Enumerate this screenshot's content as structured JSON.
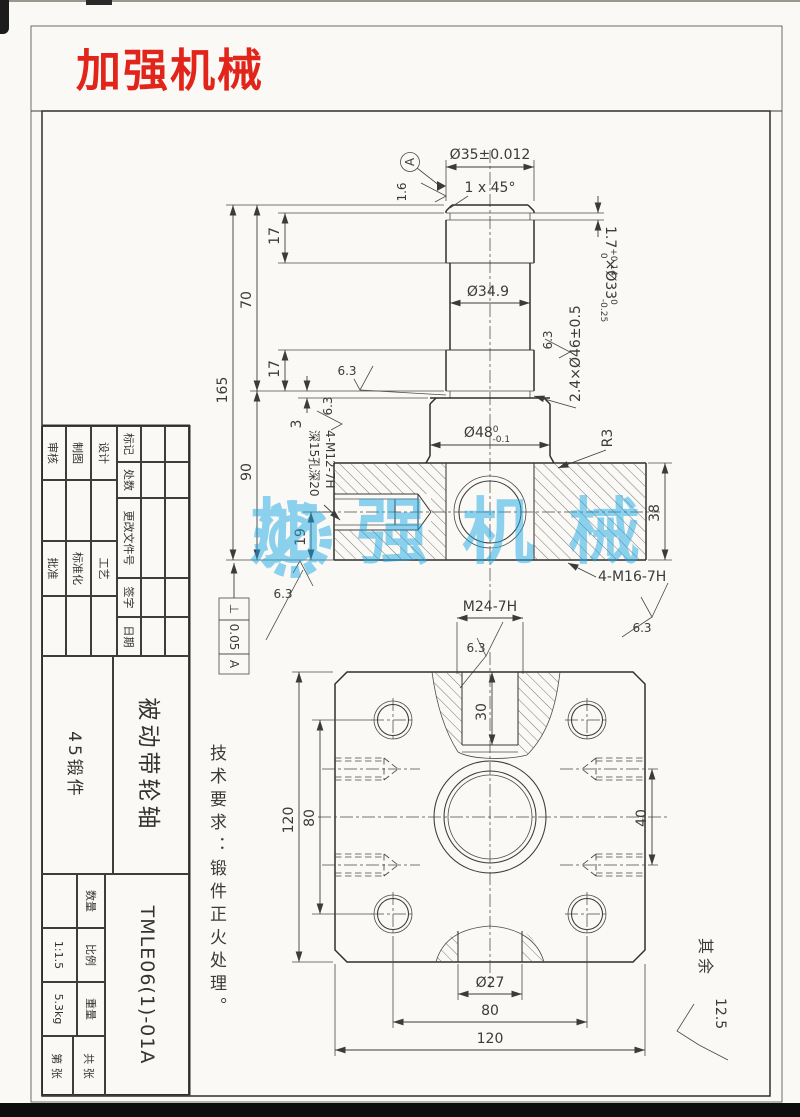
{
  "page": {
    "brand": "加强机械",
    "watermark_text": "加强机械",
    "tech_note": "技术要求：锻件正火处理。",
    "rest_label": "其余",
    "rest_value": "12.5"
  },
  "front": {
    "dia35": "Ø35±0.012",
    "chamfer": "1 x 45°",
    "datum": "A",
    "ra16": "1.6",
    "ra63": "6.3",
    "groove1_main": "1.7",
    "groove1_sup": "+0.14",
    "groove1_sub": "0",
    "groove1_dia": "×Ø33",
    "groove1_dia_sup": "0",
    "groove1_dia_sub": "-0.25",
    "groove2": "2.4×Ø46±0.5",
    "dia349": "Ø34.9",
    "dia48_main": "Ø48",
    "dia48_sup": "0",
    "dia48_sub": "-0.1",
    "r3": "R3",
    "m12_note1": "4-M12-7H",
    "m12_note2": "深15孔深20",
    "m16_note": "4-M16-7H",
    "m24_note": "M24-7H",
    "d165": "165",
    "d70": "70",
    "d17a": "17",
    "d17b": "17",
    "d90": "90",
    "d3": "3",
    "d19": "19",
    "d38": "38",
    "gdt_symbol": "⊥",
    "gdt_value": "0.05",
    "gdt_datum": "A"
  },
  "plan": {
    "d30": "30",
    "d120v": "120",
    "d80v": "80",
    "d40": "40",
    "dia27": "Ø27",
    "d80h": "80",
    "d120h": "120"
  },
  "title_block": {
    "change_headers": [
      "标记",
      "处数",
      "更改文件号",
      "签字",
      "日期"
    ],
    "sign_left": [
      "设计",
      "制图",
      "审核"
    ],
    "sign_right": [
      "工艺",
      "标准化",
      "批准"
    ],
    "part_name": "被动带轮轴",
    "material": "45锻件",
    "drawing_no": "TMLE06(1)-01A",
    "qty_label": "数量",
    "scale_label": "比例",
    "scale_value": "1:1.5",
    "weight_label": "重量",
    "weight_value": "5.3kg",
    "sheet_total": "共  张",
    "sheet_no": "第  张"
  }
}
